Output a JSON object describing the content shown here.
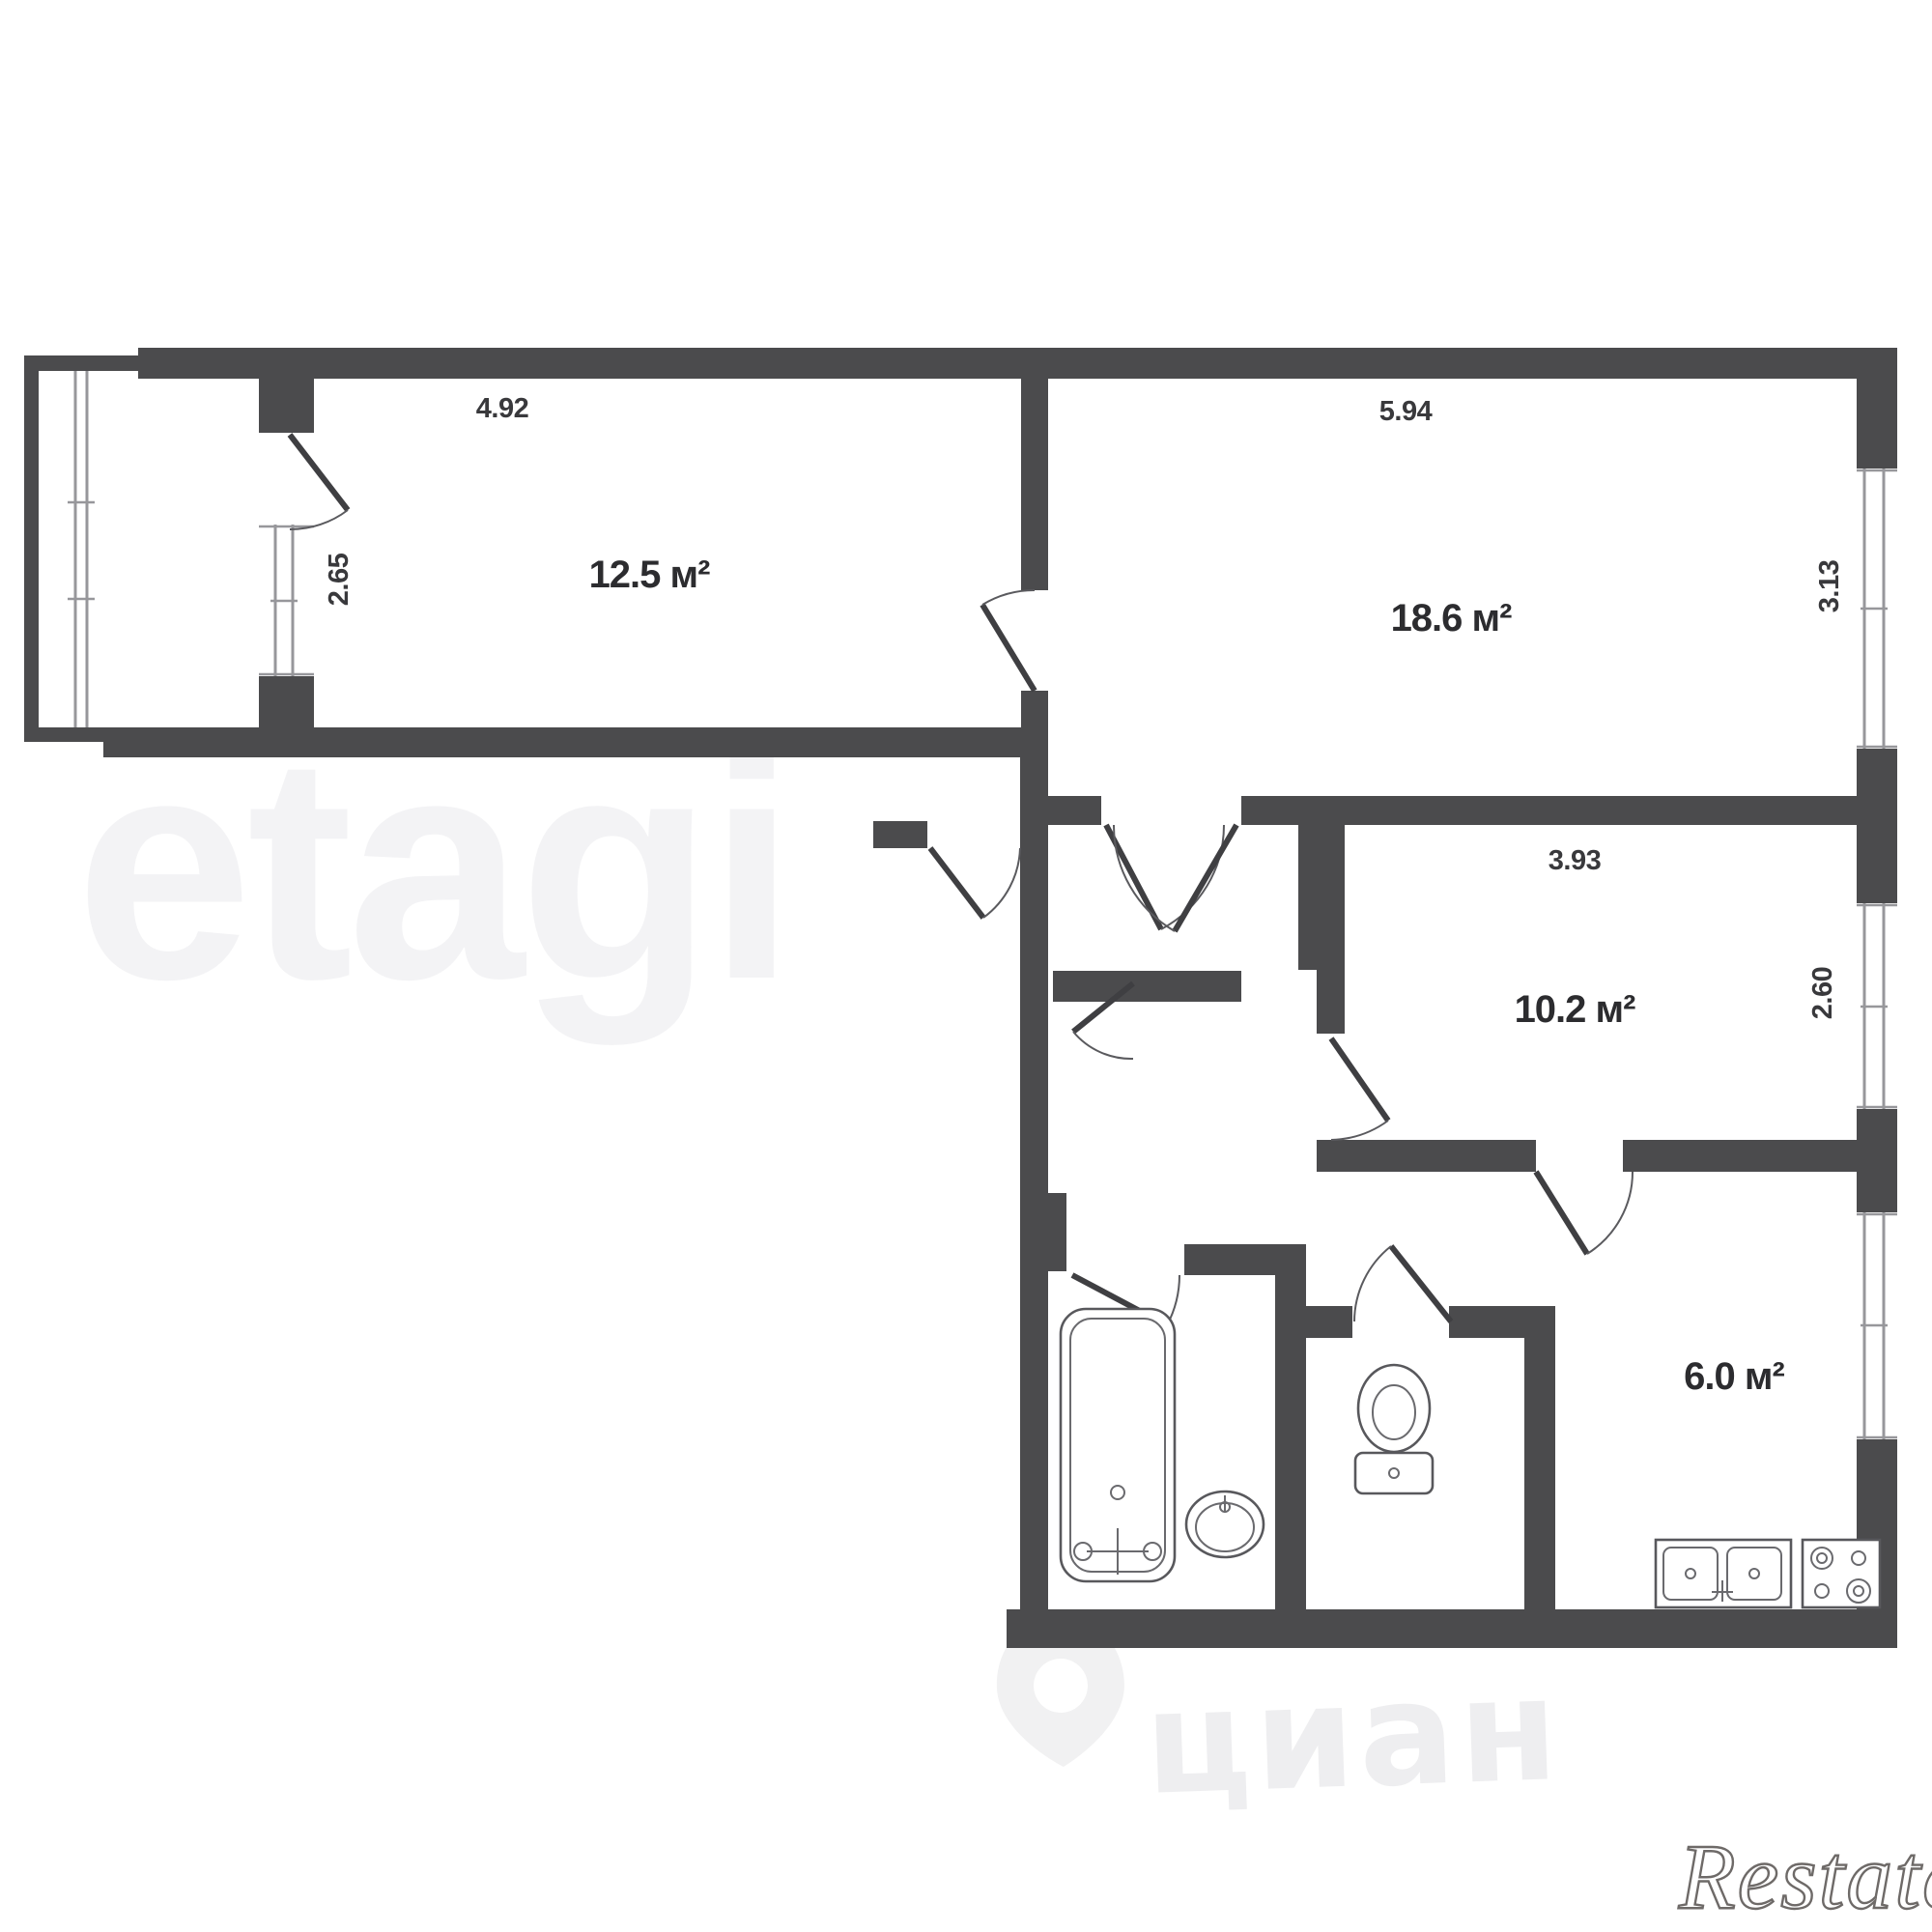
{
  "plan": {
    "rooms": [
      {
        "id": "room-12-5",
        "area_label": "12.5 м²"
      },
      {
        "id": "room-18-6",
        "area_label": "18.6 м²"
      },
      {
        "id": "room-10-2",
        "area_label": "10.2 м²"
      },
      {
        "id": "kitchen-6-0",
        "area_label": "6.0 м²"
      }
    ],
    "dimensions": {
      "room_12_5_width": "4.92",
      "room_12_5_depth": "2.65",
      "room_18_6_width": "5.94",
      "room_18_6_depth": "3.13",
      "room_10_2_width": "3.93",
      "room_10_2_depth": "2.60"
    },
    "fixtures": [
      "bathtub",
      "washbasin",
      "toilet",
      "kitchen-sink",
      "stove"
    ],
    "colors": {
      "wall": "#4b4b4d",
      "label_text": "#2c2c2f",
      "dimension_text": "#39393c",
      "window_line": "#97979b"
    }
  },
  "watermarks": {
    "center": "etagi",
    "portal": "циан",
    "corner": "Restate"
  }
}
